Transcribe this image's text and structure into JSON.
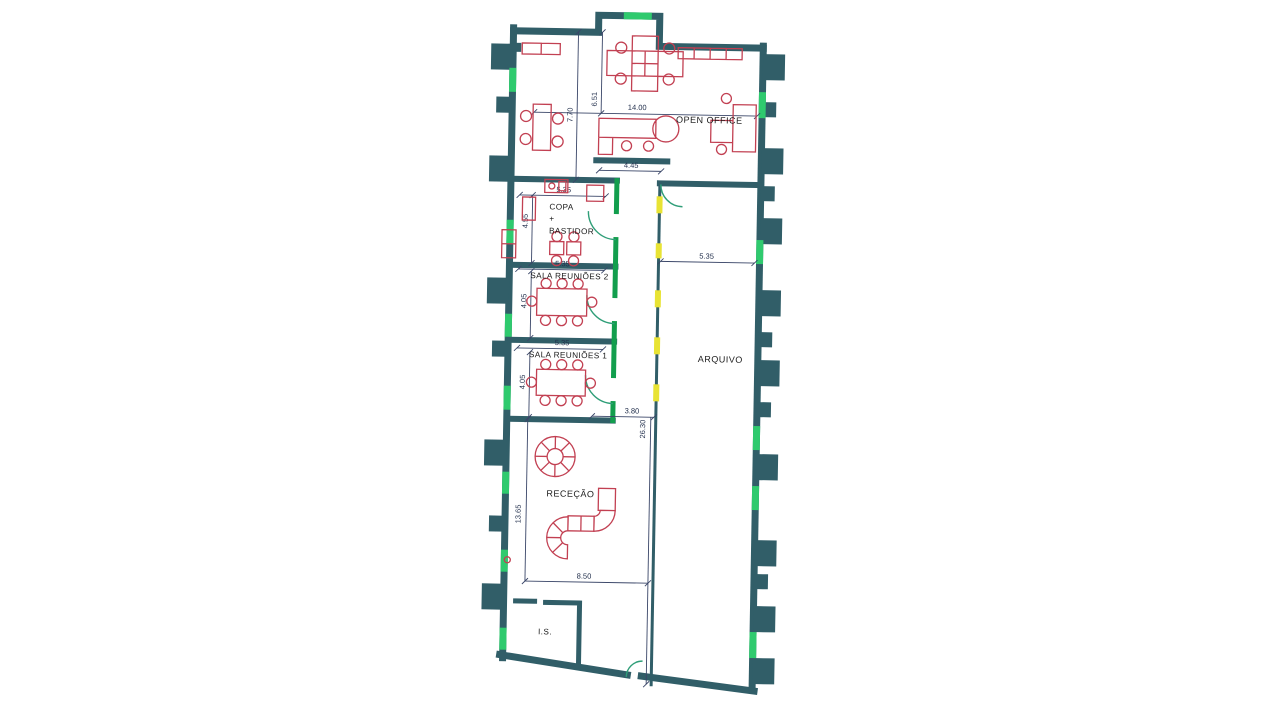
{
  "plan": {
    "type": "architectural-floor-plan",
    "rooms": {
      "open_office": "OPEN OFFICE",
      "copa_1": "COPA",
      "copa_2": "+",
      "copa_3": "BASTIDOR",
      "sala_reunioes_2": "SALA REUNIÕES 2",
      "sala_reunioes_1": "SALA REUNIÕES 1",
      "arquivo": "ARQUIVO",
      "rececao": "RECEÇÃO",
      "instalacao_sanitaria": "I.S."
    },
    "dims": {
      "open_width": "14.00",
      "open_height": "7.70",
      "open_inner": "6.51",
      "partition": "4.45",
      "copa_width": "5.35",
      "copa_depth": "4.55",
      "sala2_width": "5.35",
      "sala2_depth": "4.05",
      "sala1_width": "5.35",
      "sala1_depth": "4.05",
      "corridor_entry": "3.80",
      "corridor_length": "26.30",
      "arquivo_width": "5.35",
      "rececao_depth": "13.65",
      "rececao_width": "8.50"
    },
    "colors": {
      "exterior_wall": "#315e68",
      "interior_partition_green": "#129e4d",
      "window_green": "#2fca6e",
      "corridor_highlight_yellow": "#e8e334",
      "furniture_red": "#c24052",
      "dimension_blue": "#3a4668",
      "background": "#ffffff"
    }
  }
}
